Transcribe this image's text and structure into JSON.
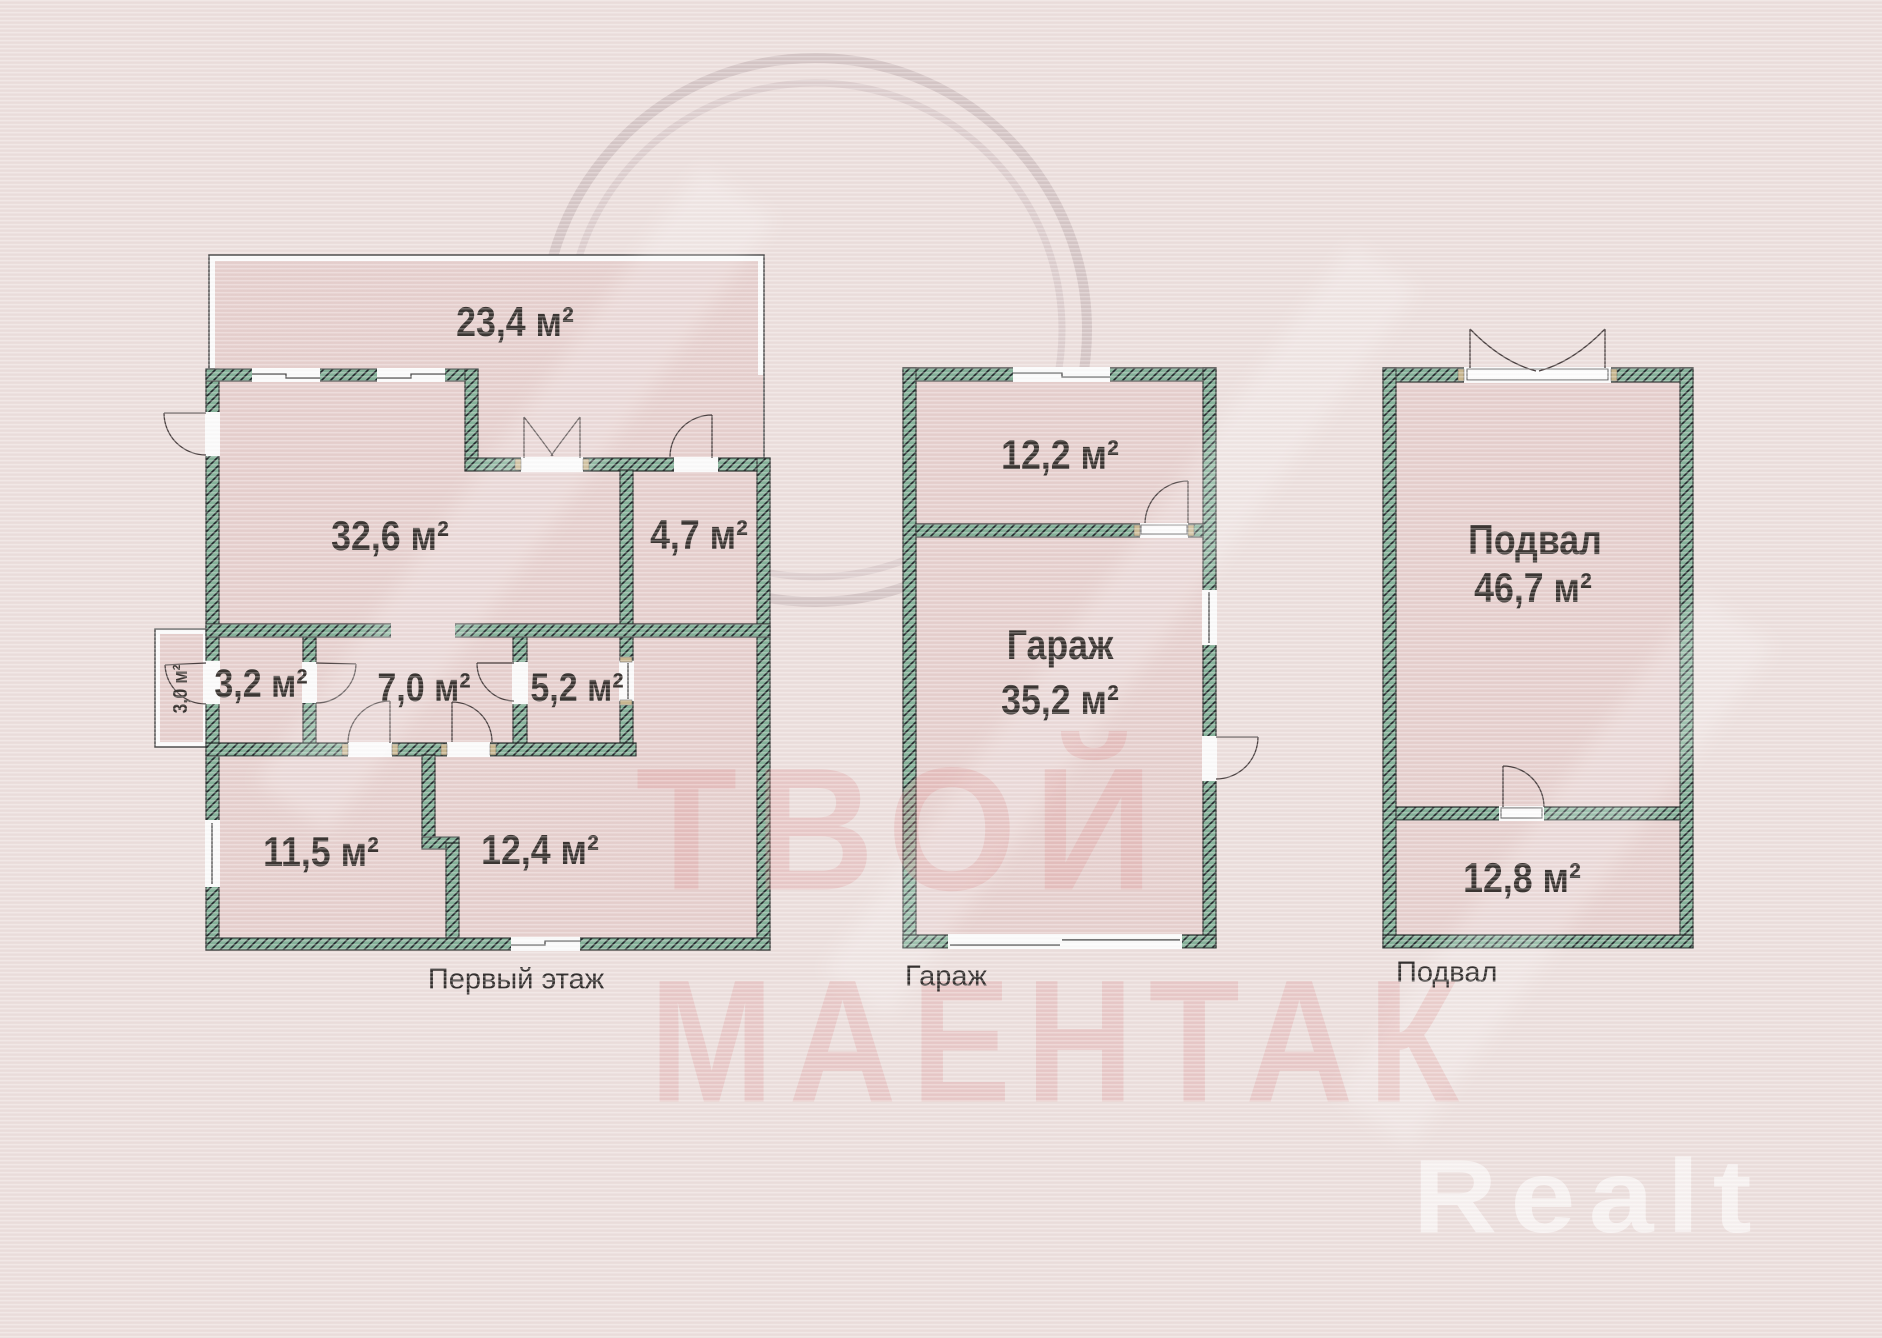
{
  "plans": {
    "first_floor": {
      "caption": "Первый этаж",
      "rooms": {
        "terrace_area": "23,4 м²",
        "living_area": "32,6 м²",
        "room_4_7": "4,7 м²",
        "room_3_2": "3,2 м²",
        "hall_7_0": "7,0 м²",
        "room_5_2": "5,2 м²",
        "porch_3_0": "3,0 м²",
        "room_11_5": "11,5 м²",
        "room_12_4": "12,4 м²"
      }
    },
    "garage": {
      "caption": "Гараж",
      "rooms": {
        "room_12_2": "12,2 м²",
        "garage_name": "Гараж",
        "garage_area": "35,2 м²"
      }
    },
    "basement": {
      "caption": "Подвал",
      "rooms": {
        "basement_name": "Подвал",
        "basement_area": "46,7 м²",
        "room_12_8": "12,8 м²"
      }
    }
  },
  "watermarks": {
    "brand_line1": "ТВОЙ",
    "brand_line2": "МАЕНТАК",
    "logo": "Realt"
  },
  "colors": {
    "background": "#ecdfdd",
    "room_fill": "#e6d0ce",
    "wall_green": "#84b198",
    "hatch_line": "#20262a",
    "wall_outline": "#2d3331",
    "label_text": "#3a3431",
    "watermark_pink": "#de9090",
    "logo_white": "#ffffff"
  }
}
